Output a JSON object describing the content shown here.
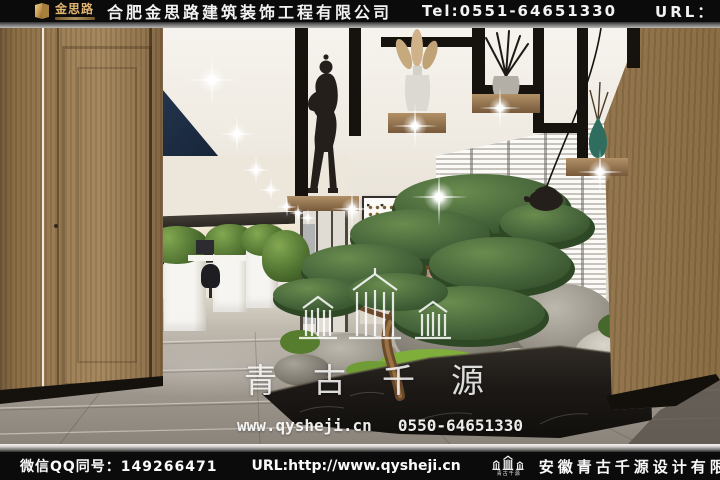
{
  "header": {
    "brand": "金思路",
    "company": "合肥金思路建筑装饰工程有限公司",
    "tel": "Tel:0551-64651330",
    "url_label": "URL：",
    "url": "www.jslu.cn"
  },
  "footer": {
    "wechat_qq": "微信QQ同号：149266471",
    "url": "URL:http://www.qysheji.cn",
    "logo_caption": "青古千源",
    "company": "安徽青古千源设计有限公司"
  },
  "watermark": {
    "brand": "青古千源",
    "url": "www.qysheji.cn",
    "phone": "0550-64651330"
  },
  "colors": {
    "bar_background": "#0b0b0b",
    "brand_gold": "#e0b470",
    "navy_ceiling": "#17253a",
    "wood_panel": "#9a7c52",
    "marble_planter": "#211d19",
    "moss_green": "#7fae3a",
    "pine_green": "#44633a",
    "floor_grey": "#a49d93"
  }
}
